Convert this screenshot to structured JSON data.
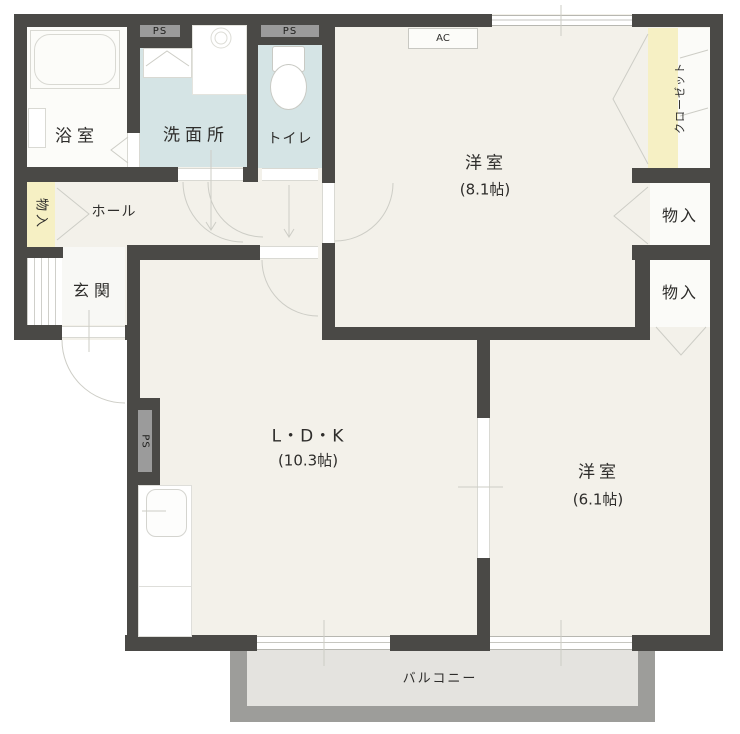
{
  "rooms": {
    "bath": {
      "label": "浴室"
    },
    "washroom": {
      "label": "洗面所"
    },
    "toilet": {
      "label": "トイレ"
    },
    "hall": {
      "label": "ホール"
    },
    "entrance": {
      "label": "玄関"
    },
    "storage_left": {
      "label": "物入"
    },
    "storage_upper": {
      "label": "物入"
    },
    "storage_lower": {
      "label": "物入"
    },
    "closet": {
      "label": "クローゼット"
    },
    "western_room_1": {
      "label": "洋室",
      "size": "(8.1帖)"
    },
    "western_room_2": {
      "label": "洋室",
      "size": "(6.1帖)"
    },
    "ldk": {
      "label": "L・D・K",
      "size": "(10.3帖)"
    },
    "balcony": {
      "label": "バルコニー"
    }
  },
  "annotations": {
    "ps": "PS",
    "ac": "AC"
  },
  "colors": {
    "wall": "#4a4946",
    "room_floor": "#f3f1ea",
    "wet_floor": "#d5e4e5",
    "accent_yellow": "#f6f0c4",
    "duct_gray": "#9b9b9b",
    "balcony_wall": "#9d9d9a",
    "balcony_floor": "#e4e3df"
  }
}
